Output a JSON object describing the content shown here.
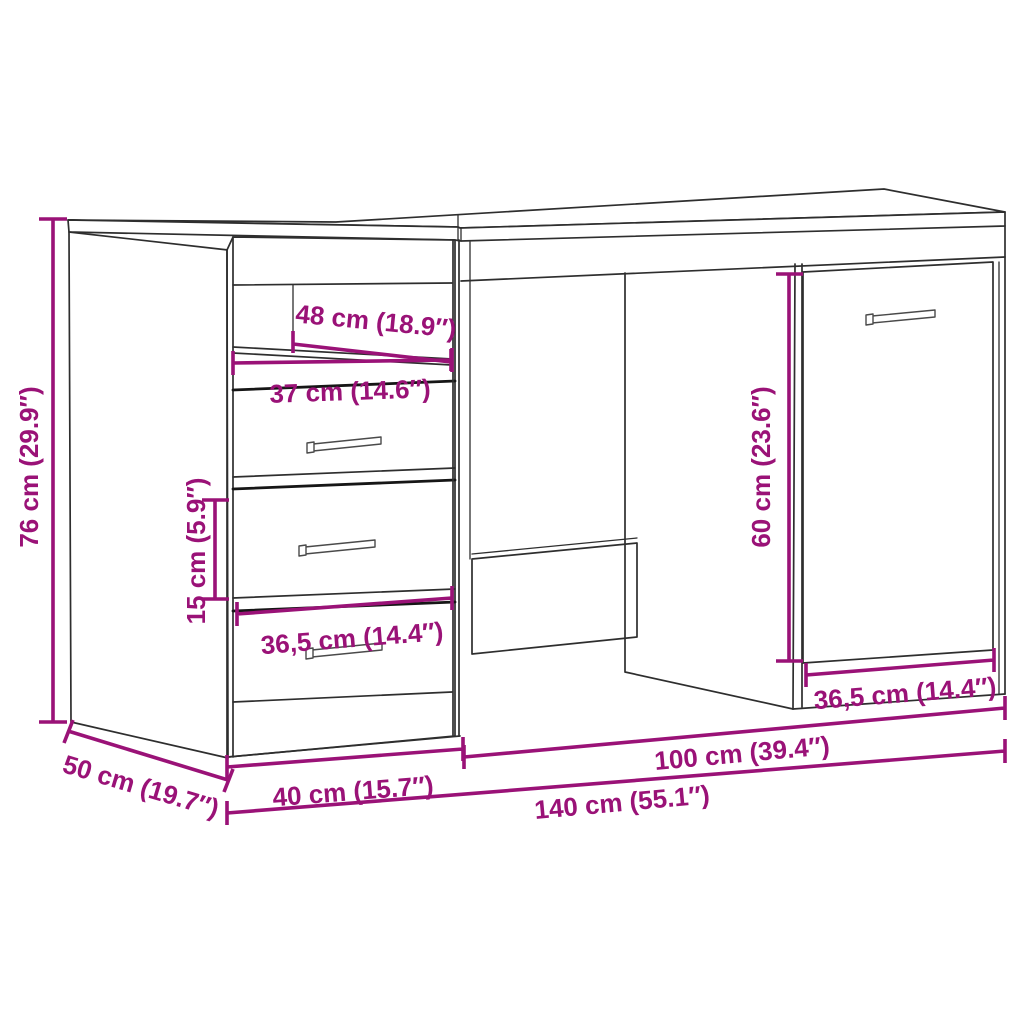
{
  "diagram": {
    "type": "furniture-dimension-diagram",
    "product": "desk with 3 drawers, open shelf and cabinet door",
    "accent_color": "#9a1277",
    "line_color": "#2e2e2e",
    "background_color": "#ffffff",
    "dimensions": {
      "total_height": "76 cm (29.9″)",
      "shelf_niche_width": "48 cm (18.9″)",
      "drawer_front_width": "37 cm (14.6″)",
      "drawer_height": "15 cm (5.9″)",
      "drawer_inner_width": "36,5 cm (14.4″)",
      "knee_clearance_height": "60 cm (23.6″)",
      "door_width": "36,5 cm (14.4″)",
      "right_section_width": "100 cm (39.4″)",
      "pedestal_width": "40 cm (15.7″)",
      "total_width": "140 cm (55.1″)",
      "depth": "50 cm (19.7″)"
    }
  }
}
